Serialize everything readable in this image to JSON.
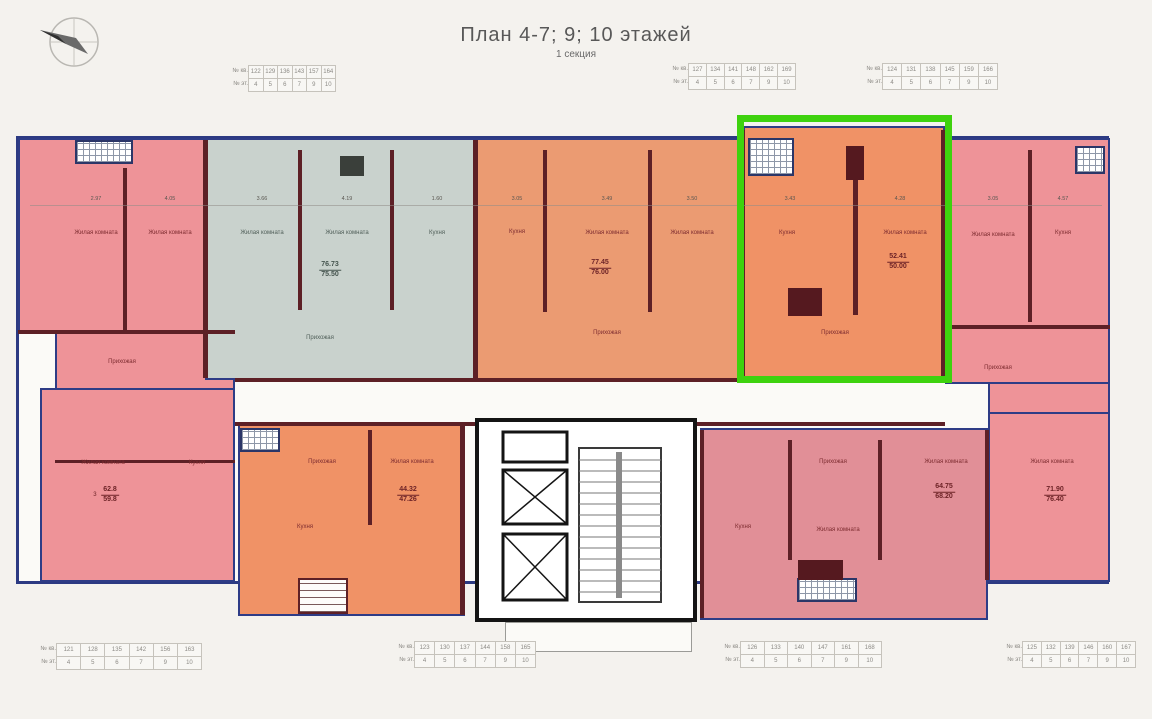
{
  "title": "План 4-7; 9; 10 этажей",
  "subtitle": "1 секция",
  "colors": {
    "selection_box": "#3ed20e",
    "exterior_wall": "#2c3a82",
    "interior_wall": "#5d2026"
  },
  "labels": {
    "living": "Жилая комната",
    "kitchen": "Кухня",
    "hall": "Прихожая"
  },
  "tables": {
    "top_left": {
      "rows": [
        {
          "label": "№ кв.",
          "values": [
            "122",
            "129",
            "136",
            "143",
            "157",
            "164"
          ]
        },
        {
          "label": "№ эт.",
          "values": [
            "4",
            "5",
            "6",
            "7",
            "9",
            "10"
          ]
        }
      ]
    },
    "top_middle": {
      "rows": [
        {
          "label": "№ кв.",
          "values": [
            "127",
            "134",
            "141",
            "148",
            "162",
            "169"
          ]
        },
        {
          "label": "№ эт.",
          "values": [
            "4",
            "5",
            "6",
            "7",
            "9",
            "10"
          ]
        }
      ]
    },
    "top_right": {
      "rows": [
        {
          "label": "№ кв.",
          "values": [
            "124",
            "131",
            "138",
            "145",
            "159",
            "166"
          ]
        },
        {
          "label": "№ эт.",
          "values": [
            "4",
            "5",
            "6",
            "7",
            "9",
            "10"
          ]
        }
      ]
    },
    "bottom_1": {
      "rows": [
        {
          "label": "№ кв.",
          "values": [
            "121",
            "128",
            "135",
            "142",
            "156",
            "163"
          ]
        },
        {
          "label": "№ эт.",
          "values": [
            "4",
            "5",
            "6",
            "7",
            "9",
            "10"
          ]
        }
      ]
    },
    "bottom_2": {
      "rows": [
        {
          "label": "№ кв.",
          "values": [
            "123",
            "130",
            "137",
            "144",
            "158",
            "165"
          ]
        },
        {
          "label": "№ эт.",
          "values": [
            "4",
            "5",
            "6",
            "7",
            "9",
            "10"
          ]
        }
      ]
    },
    "bottom_3": {
      "rows": [
        {
          "label": "№ кв.",
          "values": [
            "126",
            "133",
            "140",
            "147",
            "161",
            "168"
          ]
        },
        {
          "label": "№ эт.",
          "values": [
            "4",
            "5",
            "6",
            "7",
            "9",
            "10"
          ]
        }
      ]
    },
    "bottom_4": {
      "rows": [
        {
          "label": "№ кв.",
          "values": [
            "125",
            "132",
            "139",
            "146",
            "160",
            "167"
          ]
        },
        {
          "label": "№ эт.",
          "values": [
            "4",
            "5",
            "6",
            "7",
            "9",
            "10"
          ]
        }
      ]
    }
  },
  "areas": {
    "gray": {
      "top": "76.73",
      "bottom": "75.50"
    },
    "middle": {
      "top": "77.45",
      "bottom": "76.00"
    },
    "selected": {
      "top": "52.41",
      "bottom": "50.00"
    },
    "left": {
      "prefix": "3",
      "top": "62.8",
      "bottom": "59.8"
    },
    "bottom_middle": {
      "top": "44.32",
      "bottom": "47.26"
    },
    "bottom_right": {
      "top": "64.75",
      "bottom": "68.20"
    },
    "far_right": {
      "top": "71.90",
      "bottom": "76.40"
    }
  },
  "dims": [
    "2.97",
    "4.05",
    "3.66",
    "4.19",
    "1.60",
    "3.05",
    "3.49",
    "3.50",
    "3.43",
    "4.28",
    "3.05",
    "4.57"
  ]
}
